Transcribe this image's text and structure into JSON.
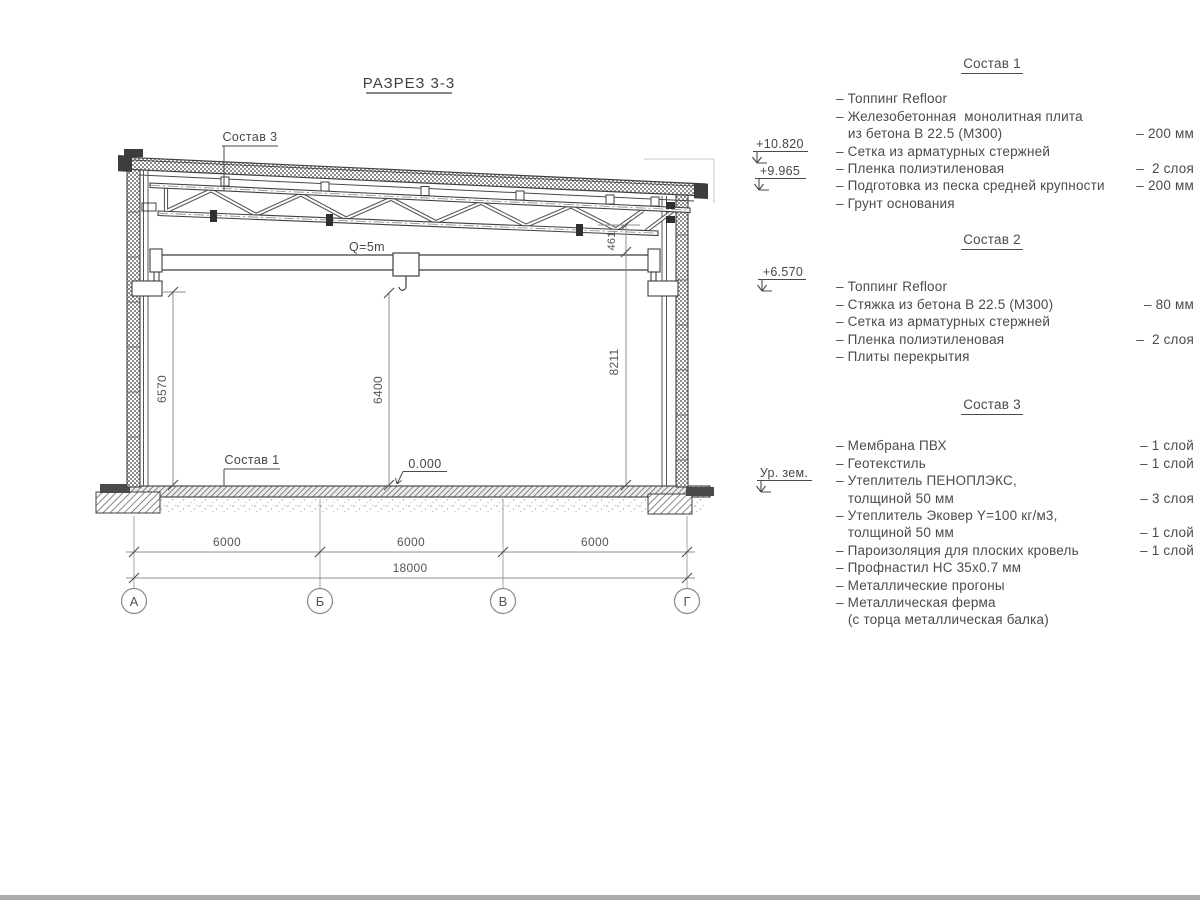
{
  "drawing": {
    "section_title": "РАЗРЕЗ 3-3",
    "crane_capacity": "Q=5m",
    "callout_top": "Состав 3",
    "callout_floor": "Состав 1",
    "level_zero": "0.000",
    "dim_left": "6570",
    "dim_center": "6400",
    "dim_right": "8211",
    "dim_truss_end": "461",
    "spans": [
      "6000",
      "6000",
      "6000"
    ],
    "span_total": "18000",
    "axes": [
      "А",
      "Б",
      "В",
      "Г"
    ],
    "elevations": {
      "parapet": "+10.820",
      "roof": "+9.965",
      "beam": "+6.570",
      "ground": "Ур. зем."
    }
  },
  "compositions": [
    {
      "title": "Состав 1",
      "rows": [
        {
          "text": "– Топпинг Refloor",
          "value": ""
        },
        {
          "text": "– Железобетонная  монолитная плита",
          "value": ""
        },
        {
          "text": "   из бетона В 22.5 (М300)",
          "value": "– 200 мм"
        },
        {
          "text": "– Сетка из арматурных стержней",
          "value": ""
        },
        {
          "text": "– Пленка полиэтиленовая",
          "value": "–  2 слоя"
        },
        {
          "text": "– Подготовка из песка средней крупности",
          "value": "– 200 мм"
        },
        {
          "text": "– Грунт основания",
          "value": ""
        }
      ]
    },
    {
      "title": "Состав 2",
      "rows": [
        {
          "text": "– Топпинг Refloor",
          "value": ""
        },
        {
          "text": "– Стяжка из бетона В 22.5 (М300)",
          "value": "– 80 мм"
        },
        {
          "text": "– Сетка из арматурных стержней",
          "value": ""
        },
        {
          "text": "– Пленка полиэтиленовая",
          "value": "–  2 слоя"
        },
        {
          "text": "– Плиты перекрытия",
          "value": ""
        }
      ]
    },
    {
      "title": "Состав 3",
      "rows": [
        {
          "text": "– Мембрана ПВХ",
          "value": "– 1 слой"
        },
        {
          "text": "– Геотекстиль",
          "value": "– 1 слой"
        },
        {
          "text": "– Утеплитель ПЕНОПЛЭКС,",
          "value": ""
        },
        {
          "text": "   толщиной 50 мм",
          "value": "– 3 слоя"
        },
        {
          "text": "– Утеплитель Эковер Y=100 кг/м3,",
          "value": ""
        },
        {
          "text": "   толщиной 50 мм",
          "value": "– 1 слой"
        },
        {
          "text": "– Пароизоляция для плоских кровель",
          "value": "– 1 слой"
        },
        {
          "text": "– Профнастил НС 35х0.7 мм",
          "value": ""
        },
        {
          "text": "– Металлические прогоны",
          "value": ""
        },
        {
          "text": "– Металлическая ферма",
          "value": ""
        },
        {
          "text": "   (с торца металлическая балка)",
          "value": ""
        }
      ]
    }
  ]
}
